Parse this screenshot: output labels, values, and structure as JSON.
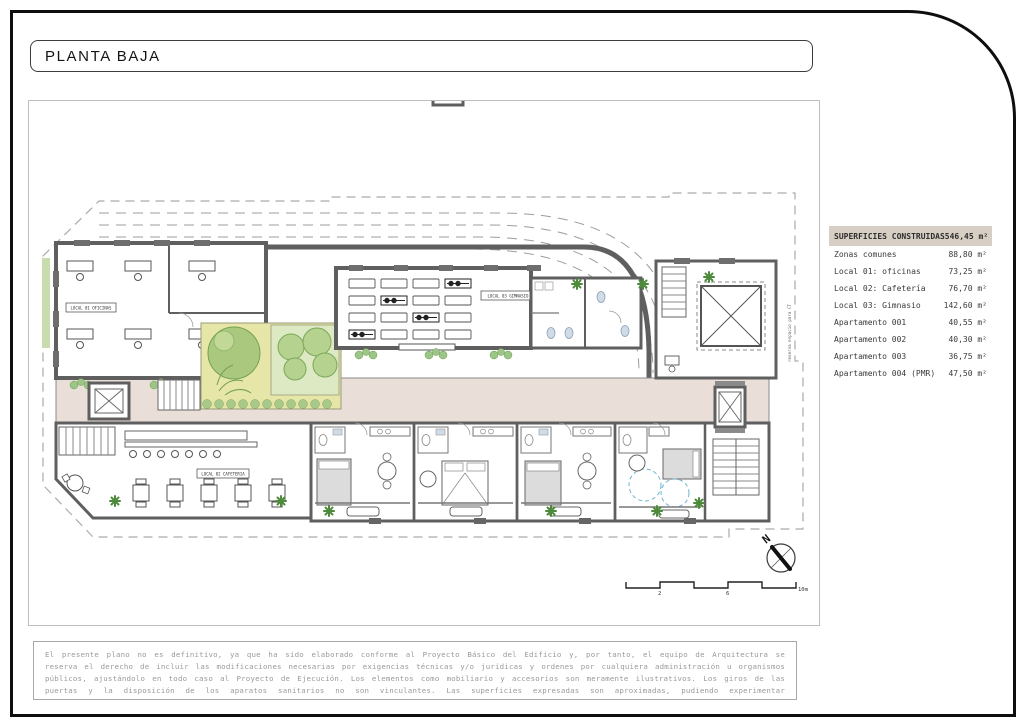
{
  "page": {
    "title": "PLANTA BAJA"
  },
  "legend": {
    "header": {
      "label": "SUPERFICIES CONSTRUIDAS",
      "value": "546,45 m²"
    },
    "rows": [
      {
        "label": "Zonas comunes",
        "value": "88,80 m²"
      },
      {
        "label": "Local 01: oficinas",
        "value": "73,25 m²"
      },
      {
        "label": "Local 02: Cafetería",
        "value": "76,70 m²"
      },
      {
        "label": "Local 03: Gimnasio",
        "value": "142,60 m²"
      },
      {
        "label": "Apartamento 001",
        "value": "40,55 m²"
      },
      {
        "label": "Apartamento 002",
        "value": "40,30 m²"
      },
      {
        "label": "Apartamento 003",
        "value": "36,75 m²"
      },
      {
        "label": "Apartamento 004 (PMR)",
        "value": "47,50 m²"
      }
    ]
  },
  "plan": {
    "labels": {
      "local01": "LOCAL 01 OFICINAS",
      "local02": "LOCAL 02 CAFETERIA",
      "local03": "LOCAL 03 GIMNASIO"
    },
    "boundary_note": "reserva espacio para CT",
    "compass_n": "N",
    "scale": {
      "t2": "2",
      "t6": "6",
      "t10": "10m"
    }
  },
  "disclaimer": {
    "text": "El presente plano no es definitivo, ya que ha sido elaborado conforme al Proyecto Básico del Edificio y, por tanto, el equipo de Arquitectura se reserva el derecho de incluir las modificaciones necesarias por exigencias técnicas y/o jurídicas y ordenes por cualquiera administración u organismos públicos, ajustándolo en todo caso al Proyecto de Ejecución. Los elementos como mobiliario y accesorios son meramente ilustrativos. Los giros de las puertas y la disposición de los aparatos sanitarios no son vinculantes. Las superficies expresadas son aproximadas, pudiendo experimentar modificaciones por razones de índole técnica y/o legal en el Proyecto de Ejecución."
  },
  "colors": {
    "wall": "#5f5f5f",
    "corridor_floor": "#eadfd8",
    "garden": "#e6e6a8",
    "garden_panel": "#dde9c2",
    "tree": "#b5d28e",
    "plant": "#4e8a3c",
    "legend_header_bg": "#d8cfc4",
    "pmr_blue": "#6fb3d2",
    "disclaimer_text": "#9a9a9a"
  }
}
